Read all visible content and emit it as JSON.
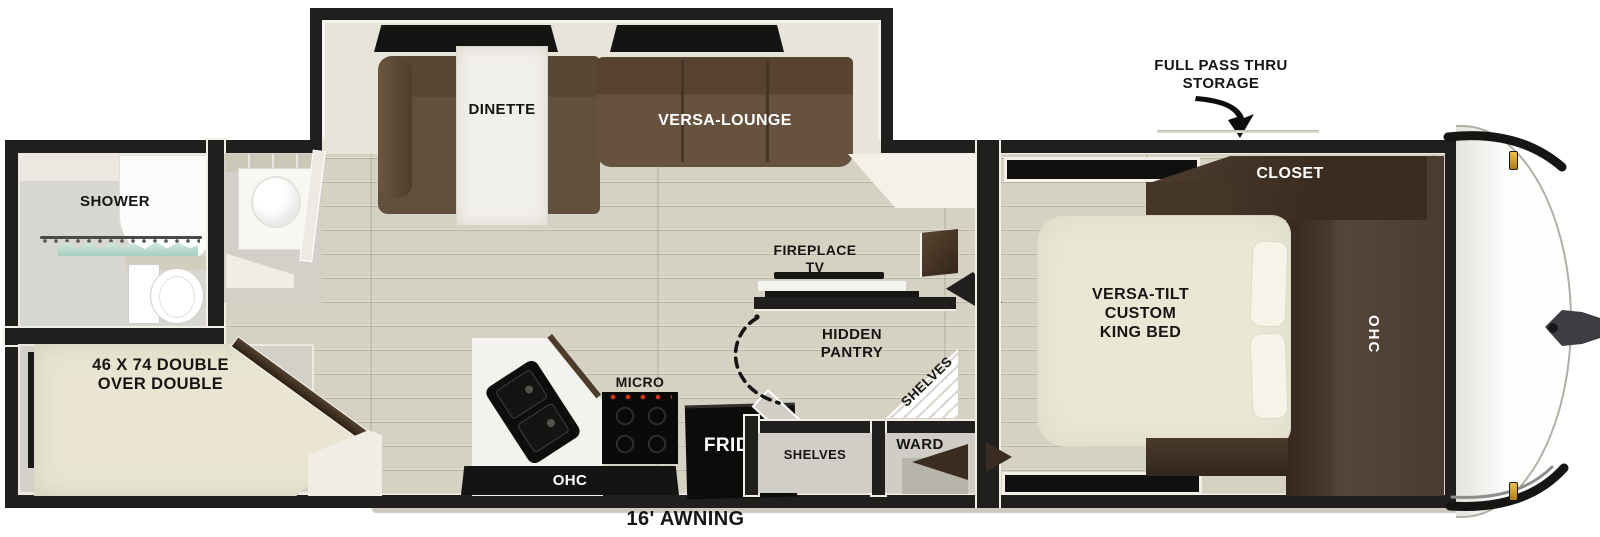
{
  "title": "Travel trailer floorplan",
  "labels": {
    "storage_callout": "FULL PASS THRU\nSTORAGE",
    "closet": "CLOSET",
    "king_bed": "VERSA-TILT\nCUSTOM\nKING BED",
    "bedroom_ohc": "OHC",
    "fireplace_tv": "FIREPLACE\nTV",
    "hidden_pantry": "HIDDEN\nPANTRY",
    "corner_shelves": "SHELVES",
    "lower_shelves": "SHELVES",
    "wardrobe": "WARD",
    "micro": "MICRO",
    "fridge": "FRIDGE",
    "kitchen_ohc": "OHC",
    "dinette": "DINETTE",
    "versa_lounge": "VERSA-LOUNGE",
    "shower": "SHOWER",
    "bunk": "46 X 74 DOUBLE\nOVER DOUBLE",
    "awning": "16' AWNING"
  },
  "colors": {
    "wall": "#201F1D",
    "floor_wood": "#D5D2C3",
    "sofa_brown": "#5F4B39",
    "cabinet_dark": "#3A2C20",
    "mattress_cream": "#EBE7D5",
    "marker_amber": "#D9A433",
    "shower_teal": "#A5CFBF"
  }
}
